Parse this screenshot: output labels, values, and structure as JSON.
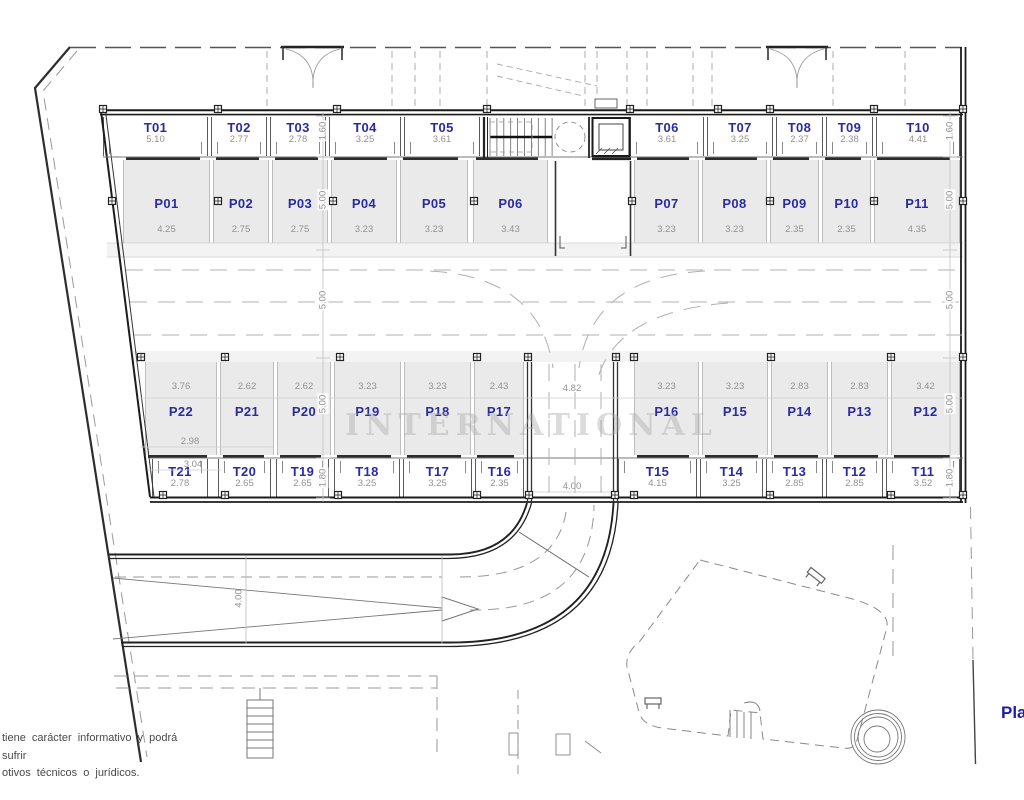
{
  "plan": {
    "sheet_title_clipped": "Pla",
    "watermark": "INTERNATIONAL",
    "disclaimer": {
      "line1": "tiene carácter informativo y podrá sufrir",
      "line2": "otivos técnicos o jurídicos."
    },
    "colors": {
      "label_blue": "#2b2ba0",
      "dim_gray": "#929292",
      "stall_fill": "#eaeaea",
      "wall_dark": "#1c1c1c"
    },
    "rows": {
      "top_storage": [
        {
          "label": "T01",
          "dim": "5.10"
        },
        {
          "label": "T02",
          "dim": "2.77"
        },
        {
          "label": "T03",
          "dim": "2.78"
        },
        {
          "label": "T04",
          "dim": "3.25"
        },
        {
          "label": "T05",
          "dim": "3.61"
        },
        {
          "label": "T06",
          "dim": "3.61"
        },
        {
          "label": "T07",
          "dim": "3.25"
        },
        {
          "label": "T08",
          "dim": "2.37"
        },
        {
          "label": "T09",
          "dim": "2.38"
        },
        {
          "label": "T10",
          "dim": "4.41"
        }
      ],
      "top_parking": [
        {
          "label": "P01",
          "dim": "4.25"
        },
        {
          "label": "P02",
          "dim": "2.75"
        },
        {
          "label": "P03",
          "dim": "2.75"
        },
        {
          "label": "P04",
          "dim": "3.23"
        },
        {
          "label": "P05",
          "dim": "3.23"
        },
        {
          "label": "P06",
          "dim": "3.43"
        },
        {
          "label": "P07",
          "dim": "3.23"
        },
        {
          "label": "P08",
          "dim": "3.23"
        },
        {
          "label": "P09",
          "dim": "2.35"
        },
        {
          "label": "P10",
          "dim": "2.35"
        },
        {
          "label": "P11",
          "dim": "4.35"
        }
      ],
      "bottom_parking": [
        {
          "label": "P22",
          "dim": "3.76"
        },
        {
          "label": "P21",
          "dim": "2.62"
        },
        {
          "label": "P20",
          "dim": "2.62"
        },
        {
          "label": "P19",
          "dim": "3.23"
        },
        {
          "label": "P18",
          "dim": "3.23"
        },
        {
          "label": "P17",
          "dim": "2.43"
        },
        {
          "label": "P16",
          "dim": "3.23"
        },
        {
          "label": "P15",
          "dim": "3.23"
        },
        {
          "label": "P14",
          "dim": "2.83"
        },
        {
          "label": "P13",
          "dim": "2.83"
        },
        {
          "label": "P12",
          "dim": "3.42"
        }
      ],
      "bottom_storage": [
        {
          "label": "T21",
          "dim": "2.78"
        },
        {
          "label": "T20",
          "dim": "2.65"
        },
        {
          "label": "T19",
          "dim": "2.65"
        },
        {
          "label": "T18",
          "dim": "3.25"
        },
        {
          "label": "T17",
          "dim": "3.25"
        },
        {
          "label": "T16",
          "dim": "2.35"
        },
        {
          "label": "T15",
          "dim": "4.15"
        },
        {
          "label": "T14",
          "dim": "3.25"
        },
        {
          "label": "T13",
          "dim": "2.85"
        },
        {
          "label": "T12",
          "dim": "2.85"
        },
        {
          "label": "T11",
          "dim": "3.52"
        }
      ]
    },
    "extra_dims": {
      "center_gap_top": "4.82",
      "center_road_width": "4.00",
      "ramp_width": "4.00",
      "p22_sub1": "2.98",
      "p22_sub2": "3.04"
    },
    "dim_chains": {
      "left": [
        "1.60",
        "5.00",
        "5.00",
        "5.00",
        "1.80"
      ],
      "right": [
        "1.60",
        "5.00",
        "5.00",
        "5.00",
        "1.80"
      ]
    }
  }
}
